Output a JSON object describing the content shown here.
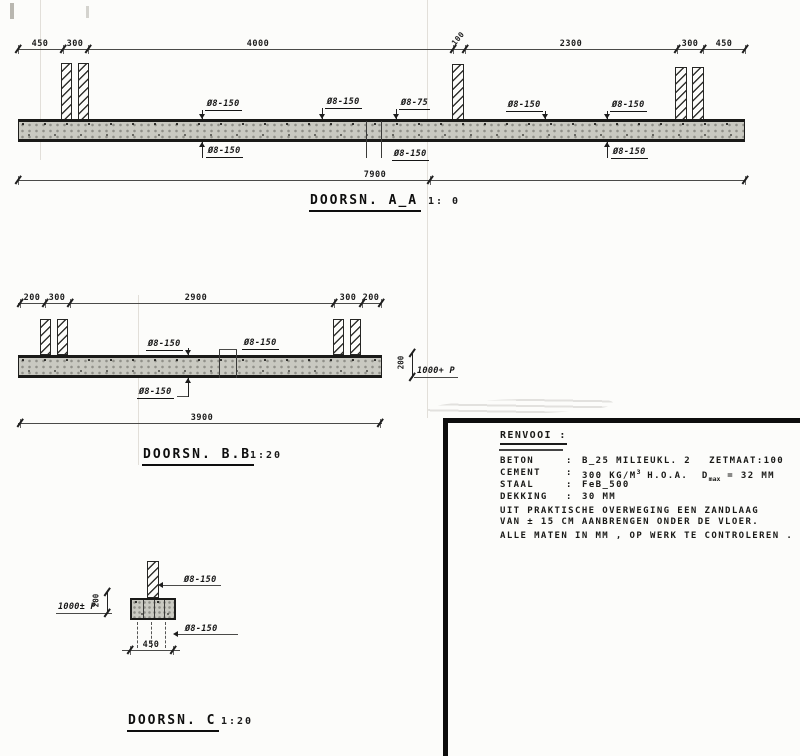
{
  "colors": {
    "ink": "#2a2a2a",
    "slab_fill": "#c9c9c1",
    "paper": "#fcfcfa"
  },
  "drawing": {
    "section_aa": {
      "title": "DOORSN. A_A",
      "scale": "1: 0",
      "dims_top": [
        "450",
        "300",
        "4000",
        "100",
        "2300",
        "300",
        "450"
      ],
      "dim_total": "7900",
      "rebar_top": [
        "Ø8-150",
        "Ø8-150",
        "Ø8-75",
        "Ø8-150",
        "Ø8-150"
      ],
      "rebar_bottom": [
        "Ø8-150",
        "Ø8-150",
        "Ø8-150"
      ]
    },
    "section_bb": {
      "title": "DOORSN. B.B",
      "scale": "1:20",
      "dims_top": [
        "200",
        "300",
        "2900",
        "300",
        "200"
      ],
      "dim_total": "3900",
      "rebar_top": [
        "Ø8-150",
        "Ø8-150"
      ],
      "rebar_bottom": [
        "Ø8-150"
      ],
      "level_mark": "1000+ P",
      "thickness": "200"
    },
    "section_c": {
      "title": "DOORSN. C",
      "scale": "1:20",
      "rebar_top": "Ø8-150",
      "rebar_bottom": "Ø8-150",
      "dim_width": "450",
      "level_mark": "1000± P",
      "thickness": "200"
    },
    "legend": {
      "title": "RENVOOI :",
      "rows": [
        {
          "label": "BETON",
          "sep": ":",
          "value": "B_25 MILIEUKL. 2",
          "extra": "ZETMAAT:100"
        },
        {
          "label": "CEMENT",
          "sep": ":",
          "value_pre": "300 KG/M",
          "sup": "3",
          "value_mid": " H.O.A.  D",
          "sub": "max",
          "value_post": " = 32 MM"
        },
        {
          "label": "STAAL",
          "sep": ":",
          "value": "FeB_500"
        },
        {
          "label": "DEKKING",
          "sep": ":",
          "value": "30 MM"
        }
      ],
      "note1a": "UIT PRAKTISCHE OVERWEGING EEN ZANDLAAG",
      "note1b": "VAN ± 15 CM AANBRENGEN ONDER DE VLOER.",
      "note2": "ALLE MATEN IN MM , OP WERK TE CONTROLEREN ."
    }
  }
}
